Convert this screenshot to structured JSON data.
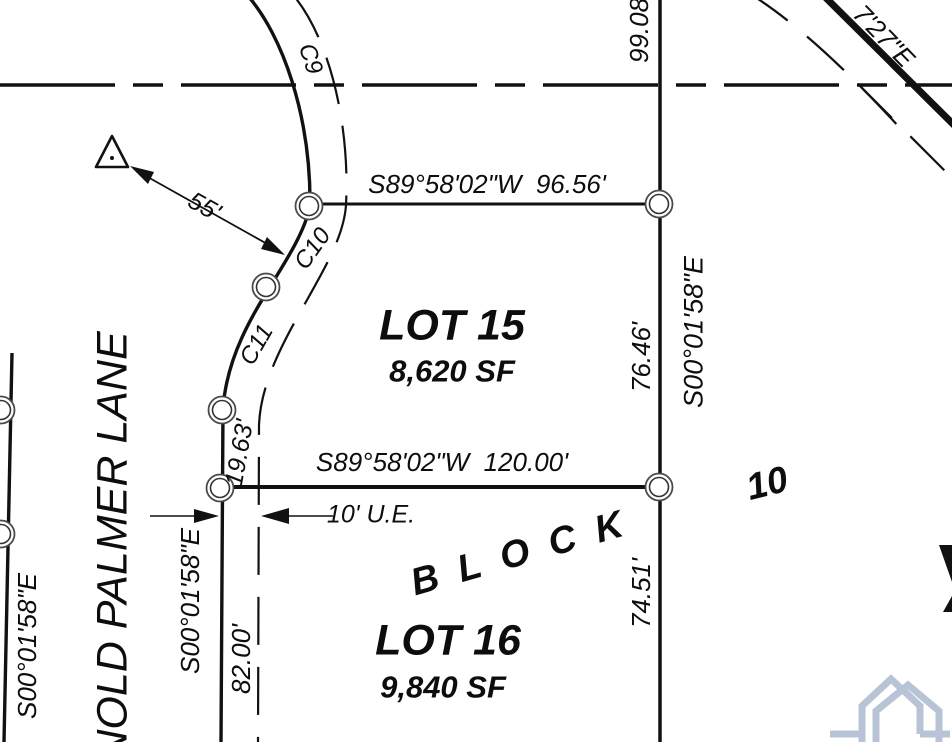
{
  "labels": {
    "bearing_top": "S89°58'02\"W  96.56'",
    "bearing_mid": "S89°58'02\"W  120.00'",
    "dist_top_right": "99.08'",
    "dist_lot15_right": "76.46'",
    "bearing_right": "S00°01'58\"E",
    "dist_lot16_right": "74.51'",
    "bearing_street_east": "S00°01'58\"E",
    "dist_lot16_left": "82.00'",
    "dist_lot15_left": "19.63'",
    "curve_c9": "C9",
    "curve_c10": "C10",
    "curve_c11": "C11",
    "dist_55": "55'",
    "easement": "10' U.E.",
    "lot15_name": "LOT 15",
    "lot15_area": "8,620 SF",
    "lot16_name": "LOT 16",
    "lot16_area": "9,840 SF",
    "block_word": "BLOCK",
    "block_number": "10",
    "street_name": "NOLD PALMER LANE",
    "bearing_far_left": "S00°01'58\"E",
    "road_bearing_fragment": "7'27\"E"
  },
  "symbols": {
    "survey_marker": "triangle-with-center-dot",
    "corner_marker": "open-double-circle",
    "watermark_logo": "twin-house-outline",
    "centerline_style": "long-short-dashed"
  },
  "colors": {
    "ink": "#111111",
    "marker_ring": "#3c3c3c",
    "logo_blue": "#b8c4d5",
    "background": "#ffffff"
  }
}
